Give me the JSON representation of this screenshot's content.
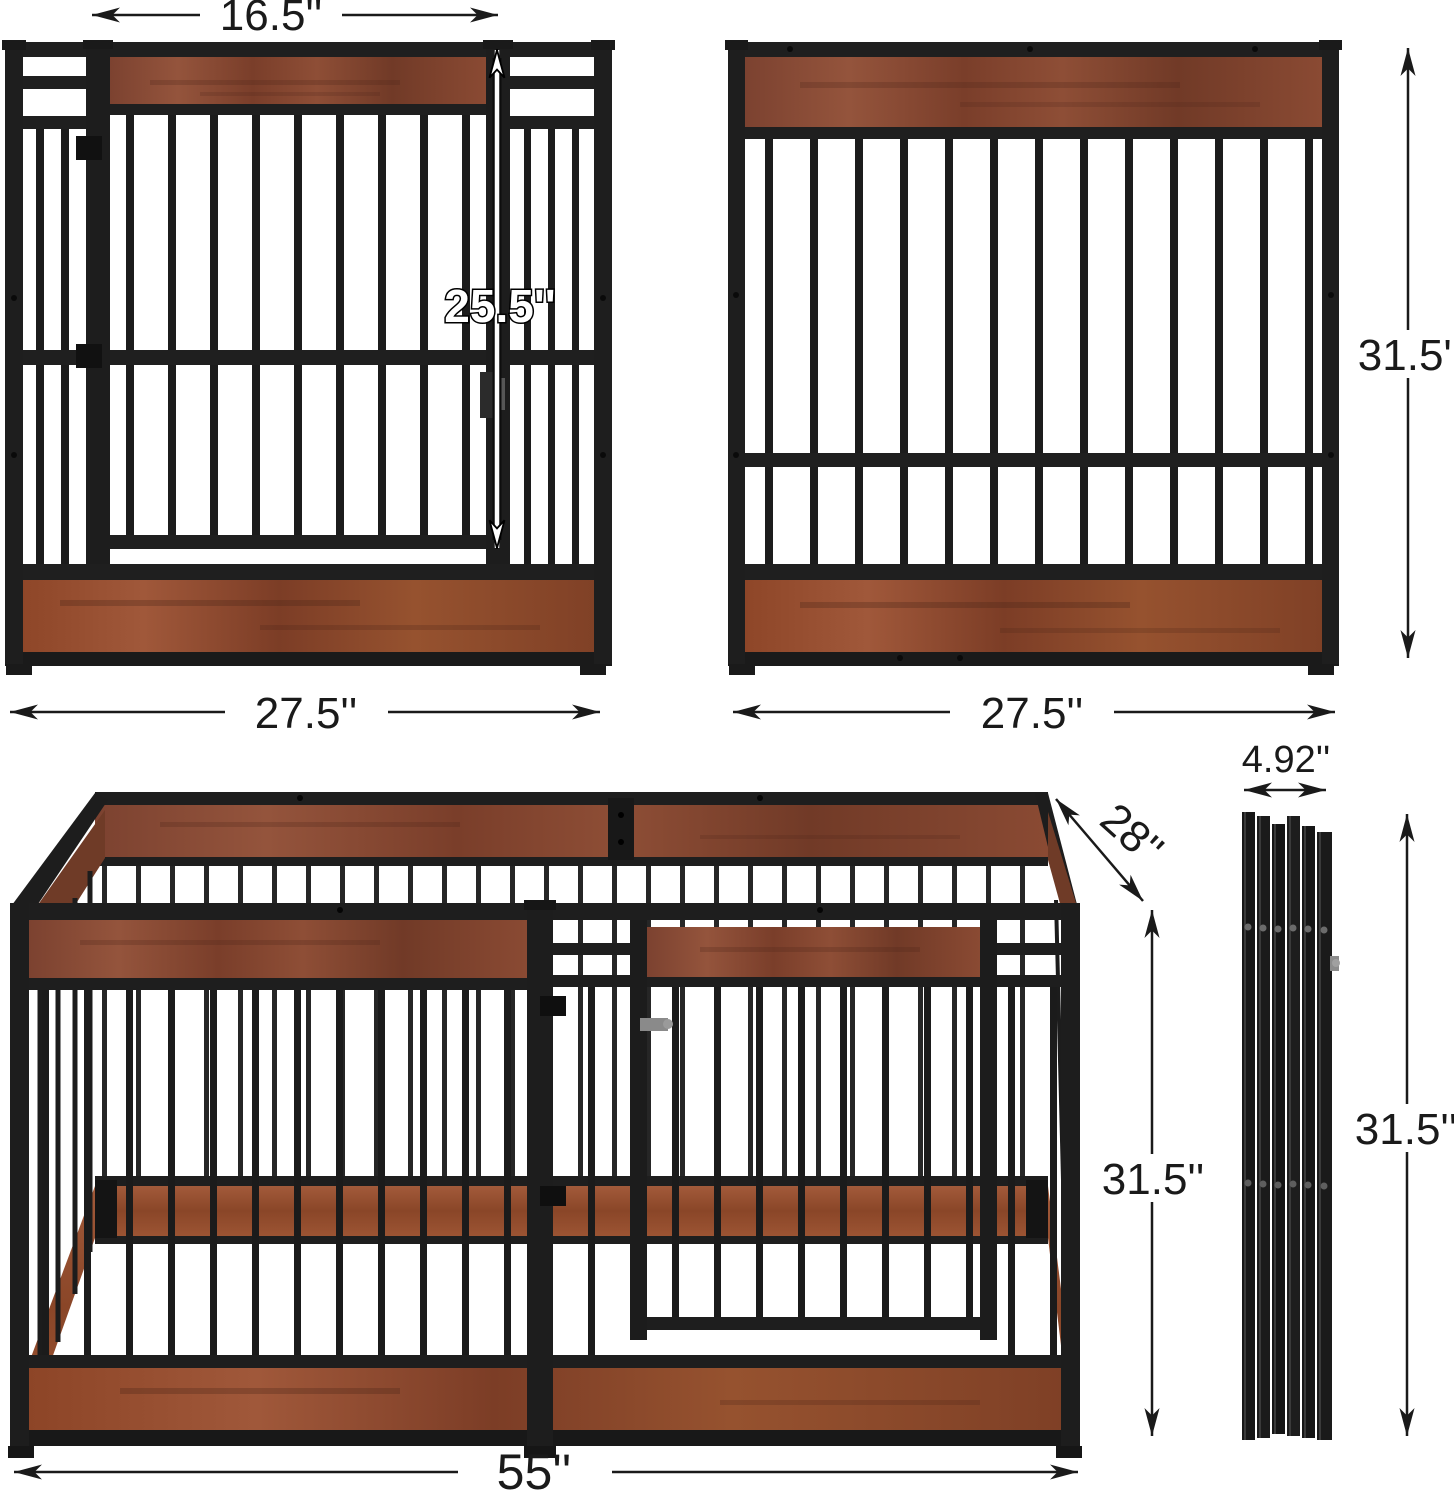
{
  "diagram": {
    "description": "Dog crate / playpen dimension diagram with four views",
    "views": {
      "door_panel": {
        "door_width": "16.5''",
        "door_height": "25.5''",
        "panel_width": "27.5''"
      },
      "plain_panel": {
        "panel_width": "27.5''",
        "panel_height": "31.5''"
      },
      "assembled_pen": {
        "width": "55''",
        "depth": "28''",
        "height": "31.5''"
      },
      "folded_panels": {
        "stack_width": "4.92''",
        "height": "31.5''"
      }
    },
    "colors": {
      "metal": "#1e1e1e",
      "wood": "#8a4a33",
      "wood_dark": "#6f3b27",
      "background": "#ffffff",
      "dimension": "#1a1a1a"
    }
  }
}
